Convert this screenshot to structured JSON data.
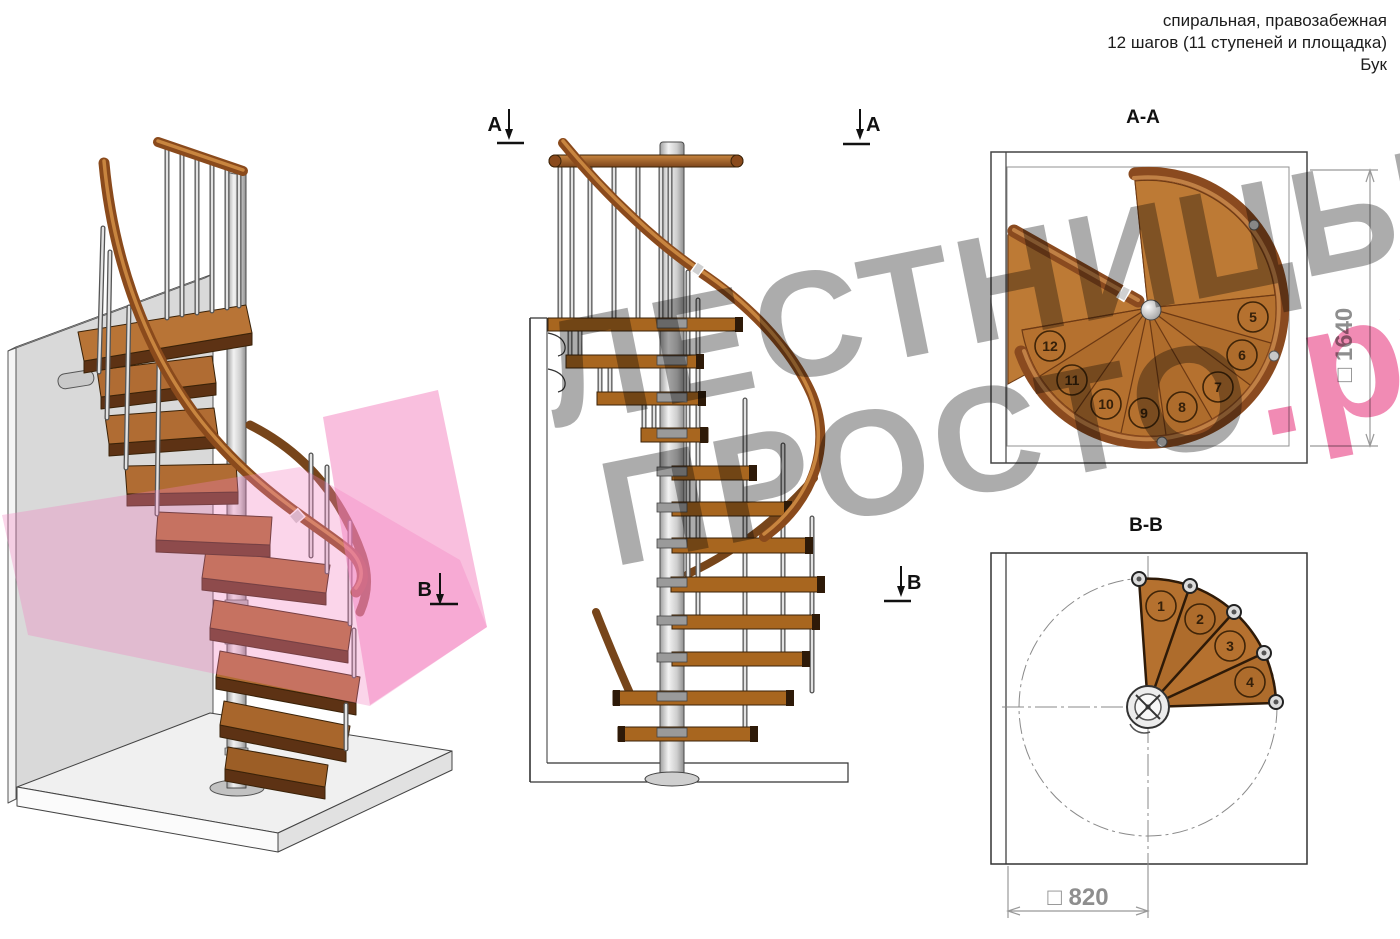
{
  "header": {
    "line1": "спиральная, правозабежная",
    "line2": "12 шагов (11 ступеней и площадка)",
    "line3": "Бук"
  },
  "watermark": {
    "line1": "ЛЕСТНИЦЫ",
    "line2_main": "ПРОСТО",
    "line2_accent": ".ру",
    "gray_color": "#a5a5a5",
    "pink_color": "#ee7fa8"
  },
  "views": {
    "iso": {
      "marker_b": "В"
    },
    "elevation": {
      "marker_a_left": "А",
      "marker_a_right": "А",
      "marker_b_right": "В"
    },
    "plan_aa": {
      "title": "А-А",
      "dimension": "□ 1640",
      "steps": [
        "5",
        "6",
        "7",
        "8",
        "9",
        "10",
        "11",
        "12"
      ]
    },
    "plan_bb": {
      "title": "В-В",
      "dimension": "□ 820",
      "steps": [
        "1",
        "2",
        "3",
        "4"
      ]
    }
  },
  "colors": {
    "wood": "#b5712f",
    "wood_dark": "#8a4a1f",
    "steel": "#c9c9c9",
    "section_plane_pink": "#f37fbe"
  }
}
